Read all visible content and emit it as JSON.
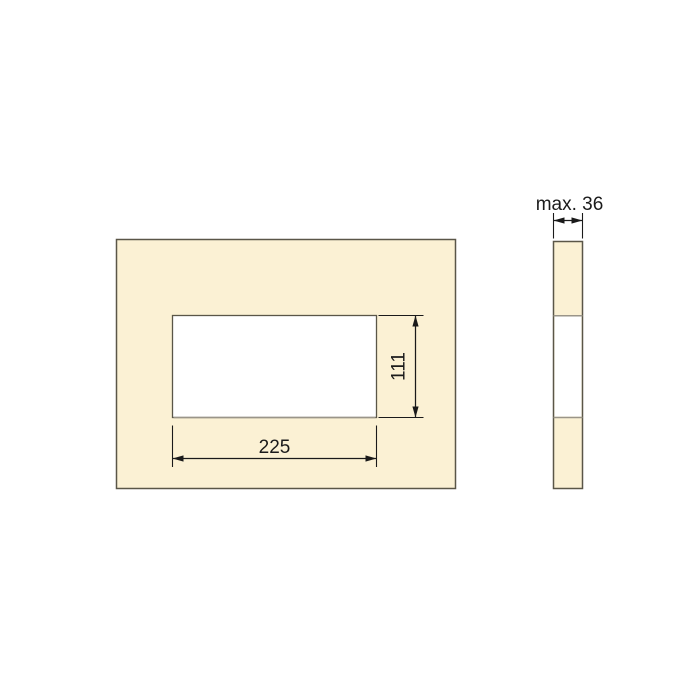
{
  "drawing": {
    "front_view": {
      "fill": "#FBF1D4",
      "cutout_fill": "#FFFFFF"
    },
    "side_view": {
      "fill": "#FBF1D4",
      "band_fill": "#FFFFFF"
    },
    "dimensions": {
      "cutout_width": "225",
      "cutout_height": "111",
      "thickness": "max. 36"
    },
    "colors": {
      "panel_fill": "#FBF1D4",
      "outline": "#5A5648",
      "separator": "#9A9589",
      "dimension_lines": "#1A1A1A",
      "text": "#1B1B1B",
      "background": "#FFFFFF"
    }
  }
}
